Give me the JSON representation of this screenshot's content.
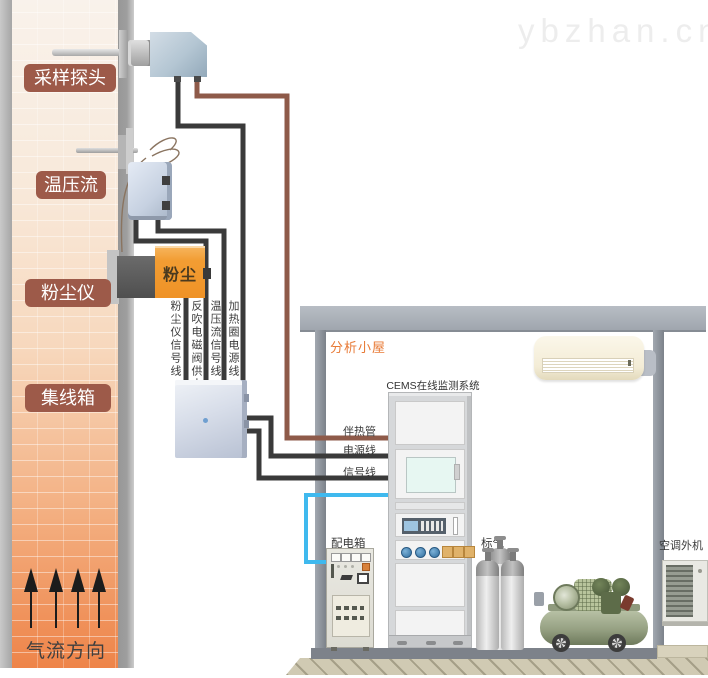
{
  "watermark": "ybzhan.cn",
  "stack": {
    "badges": [
      {
        "label": "采样探头"
      },
      {
        "label": "温压流"
      },
      {
        "label": "粉尘仪"
      },
      {
        "label": "集线箱"
      }
    ],
    "dust_device_label": "粉尘",
    "airflow_label": "气流方向"
  },
  "cable_labels": {
    "dust_signal": "粉尘仪信号线",
    "blowback_power": "反吹电磁阀供电线",
    "tpf_signal": "温压流信号线",
    "heater_power": "加热圈电源线"
  },
  "shed": {
    "title": "分析小屋",
    "cems_label": "CEMS在线监测系统",
    "line_labels": {
      "trace": "伴热管",
      "power": "电源线",
      "signal": "信号线"
    },
    "distribution_box_label": "配电箱",
    "gas_label": "标气",
    "ac_outdoor_label": "空调外机"
  },
  "colors": {
    "badge_brown": "#9d5a49",
    "stack_orange": "#ee8449",
    "dust_box_orange": "#f29d33",
    "cable_black": "#3a3a3a",
    "trace_brown": "#8e5a49",
    "power_blue": "#3fb9ee",
    "shed_gray": "#9aa0a8",
    "title_orange": "#e87a36",
    "compressor_green": "#8f9a7d"
  }
}
